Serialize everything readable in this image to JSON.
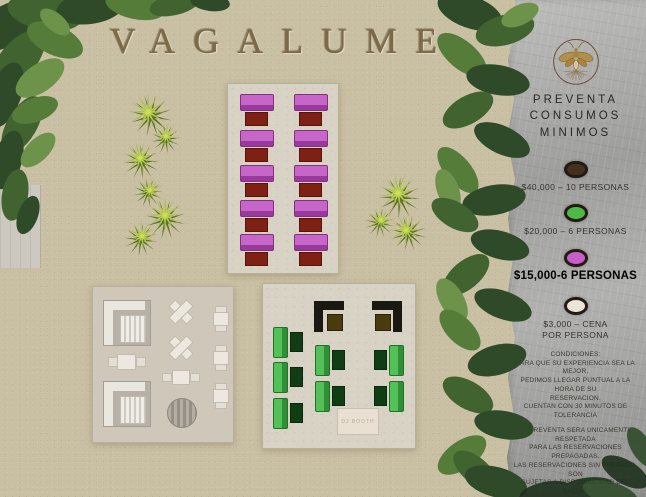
{
  "title": "VAGALUME",
  "sidebar": {
    "logo": "firefly-emblem",
    "header_lines": [
      "PREVENTA",
      "CONSUMOS",
      "MINIMOS"
    ],
    "tiers": [
      {
        "dot_color": "#44301f",
        "label": "$40,000 – 10 PERSONAS",
        "highlighted": false
      },
      {
        "dot_color": "#4cbb45",
        "label": "$20,000 – 6 PERSONAS",
        "highlighted": false
      },
      {
        "dot_color": "#c65fc9",
        "label": "$15,000-6 PERSONAS",
        "highlighted": true
      },
      {
        "dot_color": "#eae4da",
        "label": "$3,000 –  CENA",
        "label_line2": "POR PERSONA",
        "highlighted": false
      }
    ],
    "conditions": {
      "para1": [
        "CONDICIONES:",
        "PARA QUE SU EXPERIENCIA SEA LA MEJOR,",
        "PEDIMOS LLEGAR PUNTUAL A LA HORA DE SU",
        "RESERVACION.",
        "CUENTAN CON 30 MINUTOS DE TOLERANCIA"
      ],
      "para2": [
        "LA PREVENTA SERA UNICAMENTE RESPETADA",
        "PARA LAS RESERVACIONES PREPAGADAS.",
        "LAS RESERVACIONES SIN PREPAGO, SON",
        "SUJETAS A DISPONIBILIDAD DEL LUGAR"
      ]
    }
  },
  "map": {
    "dj_booth_label": "DJ BOOTH",
    "zones": {
      "magenta_booths": 10,
      "green_booths": 7,
      "black_corner_booths": 2,
      "white_lounge_sets": 2,
      "white_cross_tables": 2,
      "white_small_tables": 5,
      "white_round_tables": 1
    },
    "colors": {
      "sand": "#c9bfa3",
      "platform": "#d8d2c5",
      "magenta_sofa": "#bd5cbf",
      "red_table": "#7e1f12",
      "green_sofa": "#46b34c",
      "dark_green_table": "#113d15",
      "black_sofa": "#191912",
      "brown_table": "#4a3a10",
      "sidebar_gray": "#a5a5a3"
    }
  }
}
